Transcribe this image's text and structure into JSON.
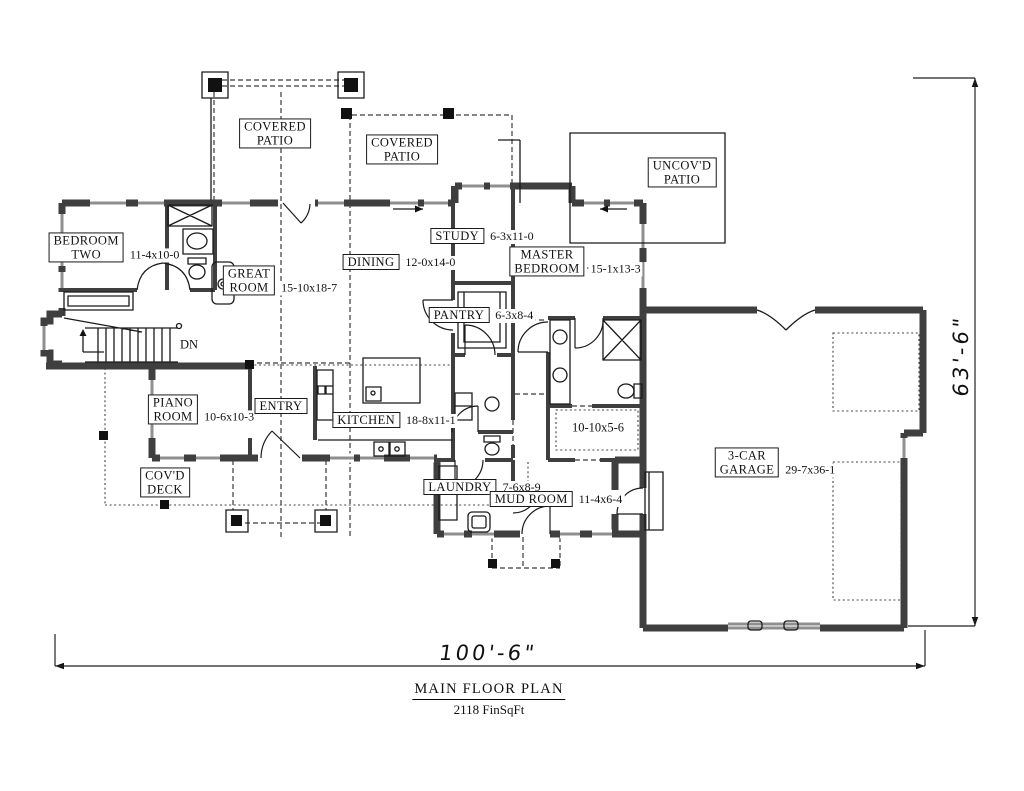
{
  "plan": {
    "title": "MAIN FLOOR PLAN",
    "area": "2118 FinSqFt",
    "overall_width": "100'-6\"",
    "overall_height": "63'-6\"",
    "stairs_note": "DN"
  },
  "rooms": {
    "covered_patio_west": {
      "name": "COVERED\nPATIO",
      "dim": ""
    },
    "covered_patio_east": {
      "name": "COVERED\nPATIO",
      "dim": ""
    },
    "uncovered_patio": {
      "name": "UNCOV'D\nPATIO",
      "dim": ""
    },
    "bedroom_two": {
      "name": "BEDROOM\nTWO",
      "dim": "11-4x10-0"
    },
    "great_room": {
      "name": "GREAT\nROOM",
      "dim": "15-10x18-7"
    },
    "dining": {
      "name": "DINING",
      "dim": "12-0x14-0"
    },
    "study": {
      "name": "STUDY",
      "dim": "6-3x11-0"
    },
    "master_bedroom": {
      "name": "MASTER\nBEDROOM",
      "dim": "15-1x13-3"
    },
    "pantry": {
      "name": "PANTRY",
      "dim": "6-3x8-4"
    },
    "piano_room": {
      "name": "PIANO\nROOM",
      "dim": "10-6x10-3"
    },
    "entry": {
      "name": "ENTRY",
      "dim": ""
    },
    "kitchen": {
      "name": "KITCHEN",
      "dim": "18-8x11-1"
    },
    "master_closet": {
      "name": "",
      "dim": "10-10x5-6"
    },
    "covered_deck": {
      "name": "COV'D\nDECK",
      "dim": ""
    },
    "laundry": {
      "name": "LAUNDRY",
      "dim": "7-6x8-9"
    },
    "mud_room": {
      "name": "MUD ROOM",
      "dim": "11-4x6-4"
    },
    "garage": {
      "name": "3-CAR\nGARAGE",
      "dim": "29-7x36-1"
    }
  }
}
